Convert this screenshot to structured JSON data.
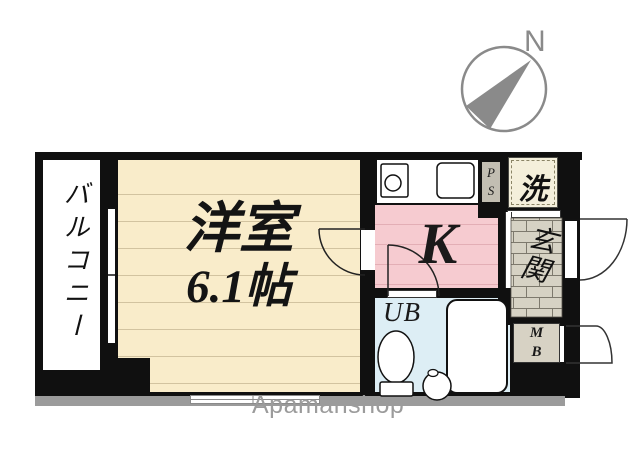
{
  "compass": {
    "north_label": "N"
  },
  "floorplan": {
    "balcony_label": "バルコニー",
    "western_room_label": "洋室",
    "western_room_size": "6.1帖",
    "kitchen_label": "K",
    "pipe_space_letters": [
      "P",
      "S"
    ],
    "laundry_label": "洗",
    "entrance_label": "玄関",
    "unit_bath_label": "UB",
    "meter_box_letters": [
      "M",
      "B"
    ]
  },
  "watermark": "Apamanshop",
  "colors": {
    "wood_floor": "#f9ecca",
    "wood_floor_line": "#d2c3a0",
    "kitchen_pink": "#f6cbd0",
    "bath_blue": "#ddeef5",
    "entrance_tile": "#d6d2c4",
    "laundry_cream": "#f4efdb",
    "wall_black": "#101010",
    "shadow_gray": "#9b9b9b",
    "compass_gray": "#8a8a8a"
  }
}
